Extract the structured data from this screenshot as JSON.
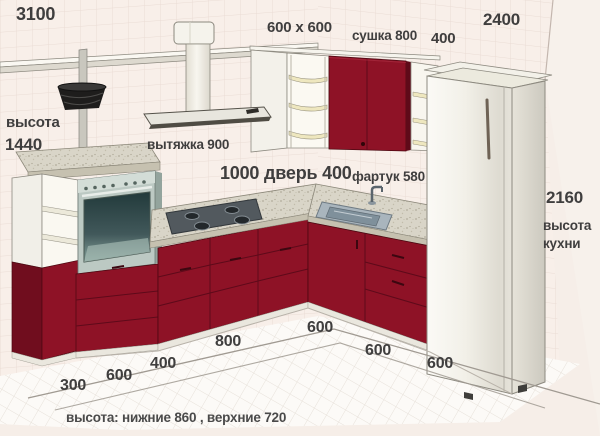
{
  "diagram": {
    "type": "kitchen-layout-3d",
    "footer": "высота:  нижние 860 , верхние 720"
  },
  "dimensions": {
    "wall_top_width": "3100",
    "corner_unit": "600 x 600",
    "dryer": "сушка 800",
    "shelf_unit_width": "400",
    "right_wall_width": "2400",
    "bar_height_label": "высота",
    "bar_height_value": "1440",
    "hood": "вытяжка 900",
    "door_run": "1000 дверь 400",
    "apron": "фартук 580",
    "kitchen_height_value": "2160",
    "kitchen_height_word1": "высота",
    "kitchen_height_word2": "кухни",
    "floor": [
      "300",
      "600",
      "400",
      "800",
      "600",
      "600",
      "600"
    ]
  },
  "colors": {
    "cabinet_front": "#8e1226",
    "cabinet_shadow": "#5f0a19",
    "countertop": "#d9d5c8",
    "wall_background": "#f6eee8",
    "tile_grid": "#eadcd5",
    "floor": "#fcfaf7",
    "label_text": "#3f3e3e"
  }
}
